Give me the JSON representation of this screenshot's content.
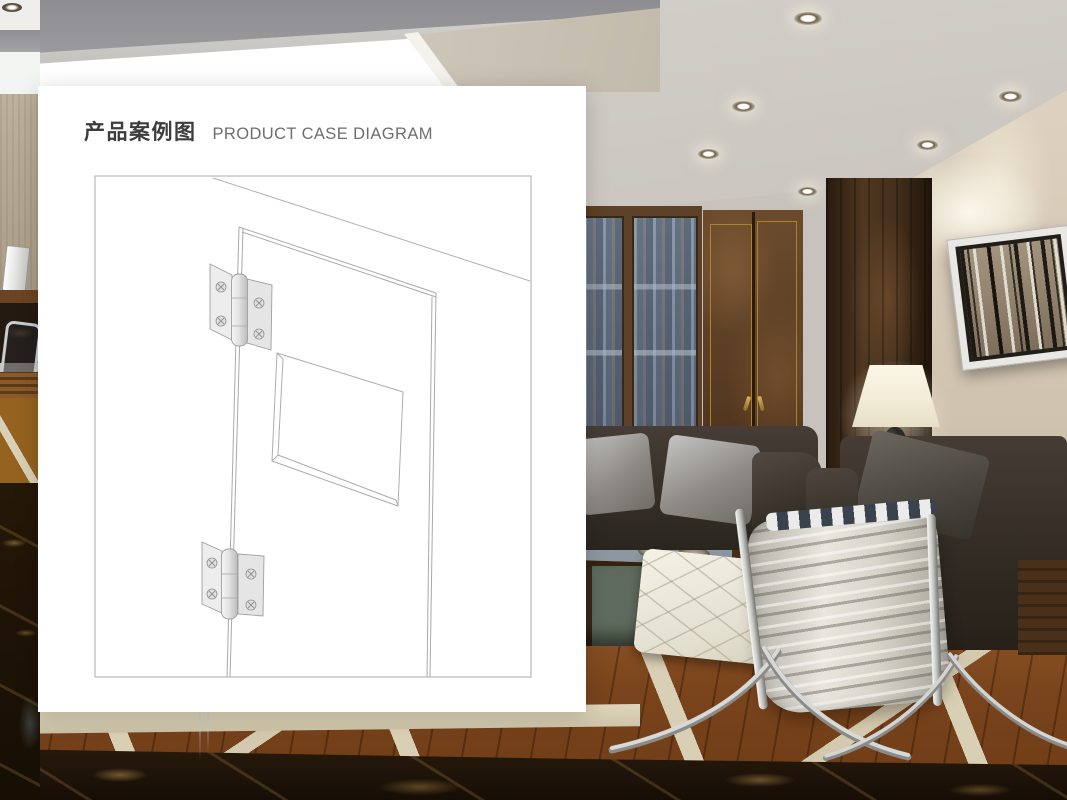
{
  "card": {
    "title_zh": "产品案例图",
    "title_en": "PRODUCT CASE DIAGRAM"
  },
  "colors": {
    "card_bg": "#ffffff",
    "diagram_line": "#b2b2b2",
    "title_zh": "#3d3d3d",
    "title_en": "#6e6e6e",
    "ceiling": "#c7c3bc",
    "cove_light": "#f4f6f3",
    "wall_beige": "#d6cab7",
    "burl_wood": "#553d24",
    "brass_trim": "#a8842f",
    "cabinet_glass": "#5d6b7e",
    "leather_sofa": "#38312a",
    "barcelona_leather": "#e8e6de",
    "chrome": "#d8d8d6",
    "lamp_shade": "#f3ecd6",
    "parquet_wood": "#7a451d",
    "marble_border": "#d9cfb4",
    "marble_dark": "#1f1409"
  }
}
